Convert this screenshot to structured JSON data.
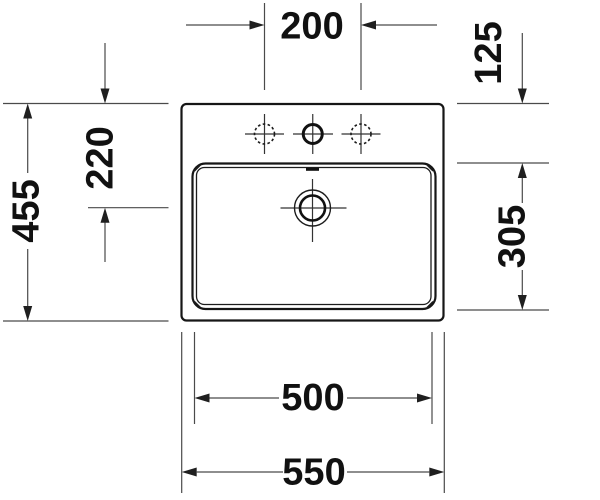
{
  "drawing": {
    "kind": "washbasin-technical-dimension-drawing",
    "background_color": "#ffffff",
    "outline_color": "#161616",
    "dimension_line_color": "#4a4a4a",
    "text_color": "#111111",
    "dimensions": {
      "faucet_hole_spacing": "200",
      "top_edge_to_bowl": "125",
      "overall_depth": "455",
      "top_edge_to_drain": "220",
      "bowl_depth": "305",
      "bowl_width": "500",
      "overall_width": "550"
    }
  }
}
